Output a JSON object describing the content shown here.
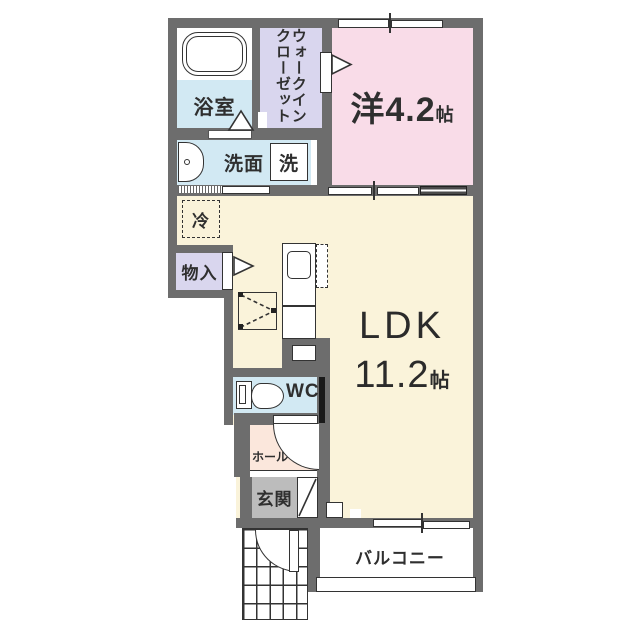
{
  "rooms": {
    "bathroom": {
      "label": "浴室"
    },
    "walk_in_closet": {
      "label_line1": "ウォークイン",
      "label_line2": "クローゼット"
    },
    "western_room": {
      "name": "洋",
      "size": "4.2",
      "size_unit": "帖"
    },
    "washroom": {
      "label": "洗面"
    },
    "washer": {
      "label": "洗"
    },
    "refrigerator": {
      "label": "冷"
    },
    "storage": {
      "label": "物入"
    },
    "ldk": {
      "name": "LDK",
      "size": "11.2",
      "size_unit": "帖"
    },
    "wc": {
      "label": "WC"
    },
    "hall": {
      "label": "ホール"
    },
    "entrance": {
      "label": "玄関"
    },
    "balcony": {
      "label": "バルコニー"
    }
  },
  "colors": {
    "wall": "#6d6d6d",
    "western_room": "#f9dce8",
    "closet": "#d9d6ee",
    "water_blue": "#d2e9f3",
    "ldk": "#faf3da",
    "hall": "#fbe7dc",
    "entrance": "#bcbcbc",
    "fixture_line": "#333333"
  }
}
